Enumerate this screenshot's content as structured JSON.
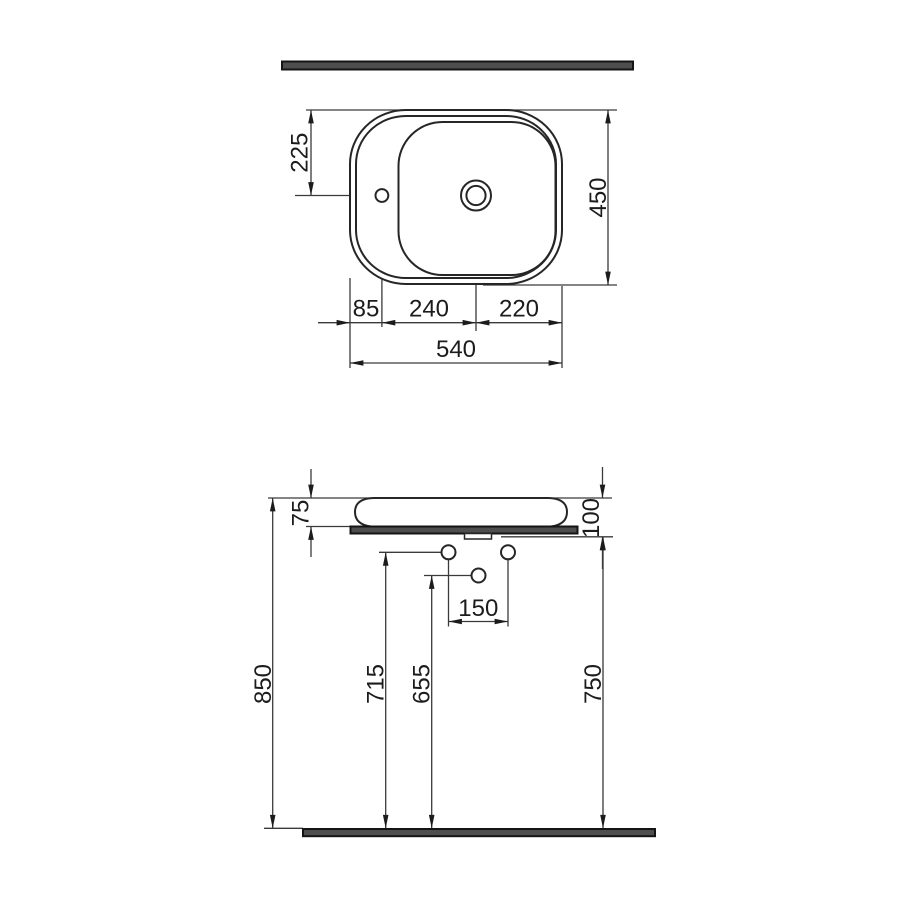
{
  "drawing": {
    "kind": "technical-dimension-drawing",
    "subject": "countertop washbasin, plan view and front elevation",
    "units": "mm"
  },
  "plan": {
    "dims": {
      "tap_offset_depth": "225",
      "depth_total": "450",
      "edge_to_tap": "85",
      "tap_to_drain": "240",
      "drain_to_edge": "220",
      "width_total": "540"
    }
  },
  "elevation": {
    "dims": {
      "basin_height": "75",
      "rim_to_underside": "100",
      "outlet_spacing": "150",
      "rim_height": "850",
      "supply_line_height": "715",
      "outlet_height": "655",
      "underside_height": "750"
    }
  },
  "colors": {
    "line": "#262626",
    "slab_fill": "#4e4e4e",
    "background": "#ffffff"
  }
}
